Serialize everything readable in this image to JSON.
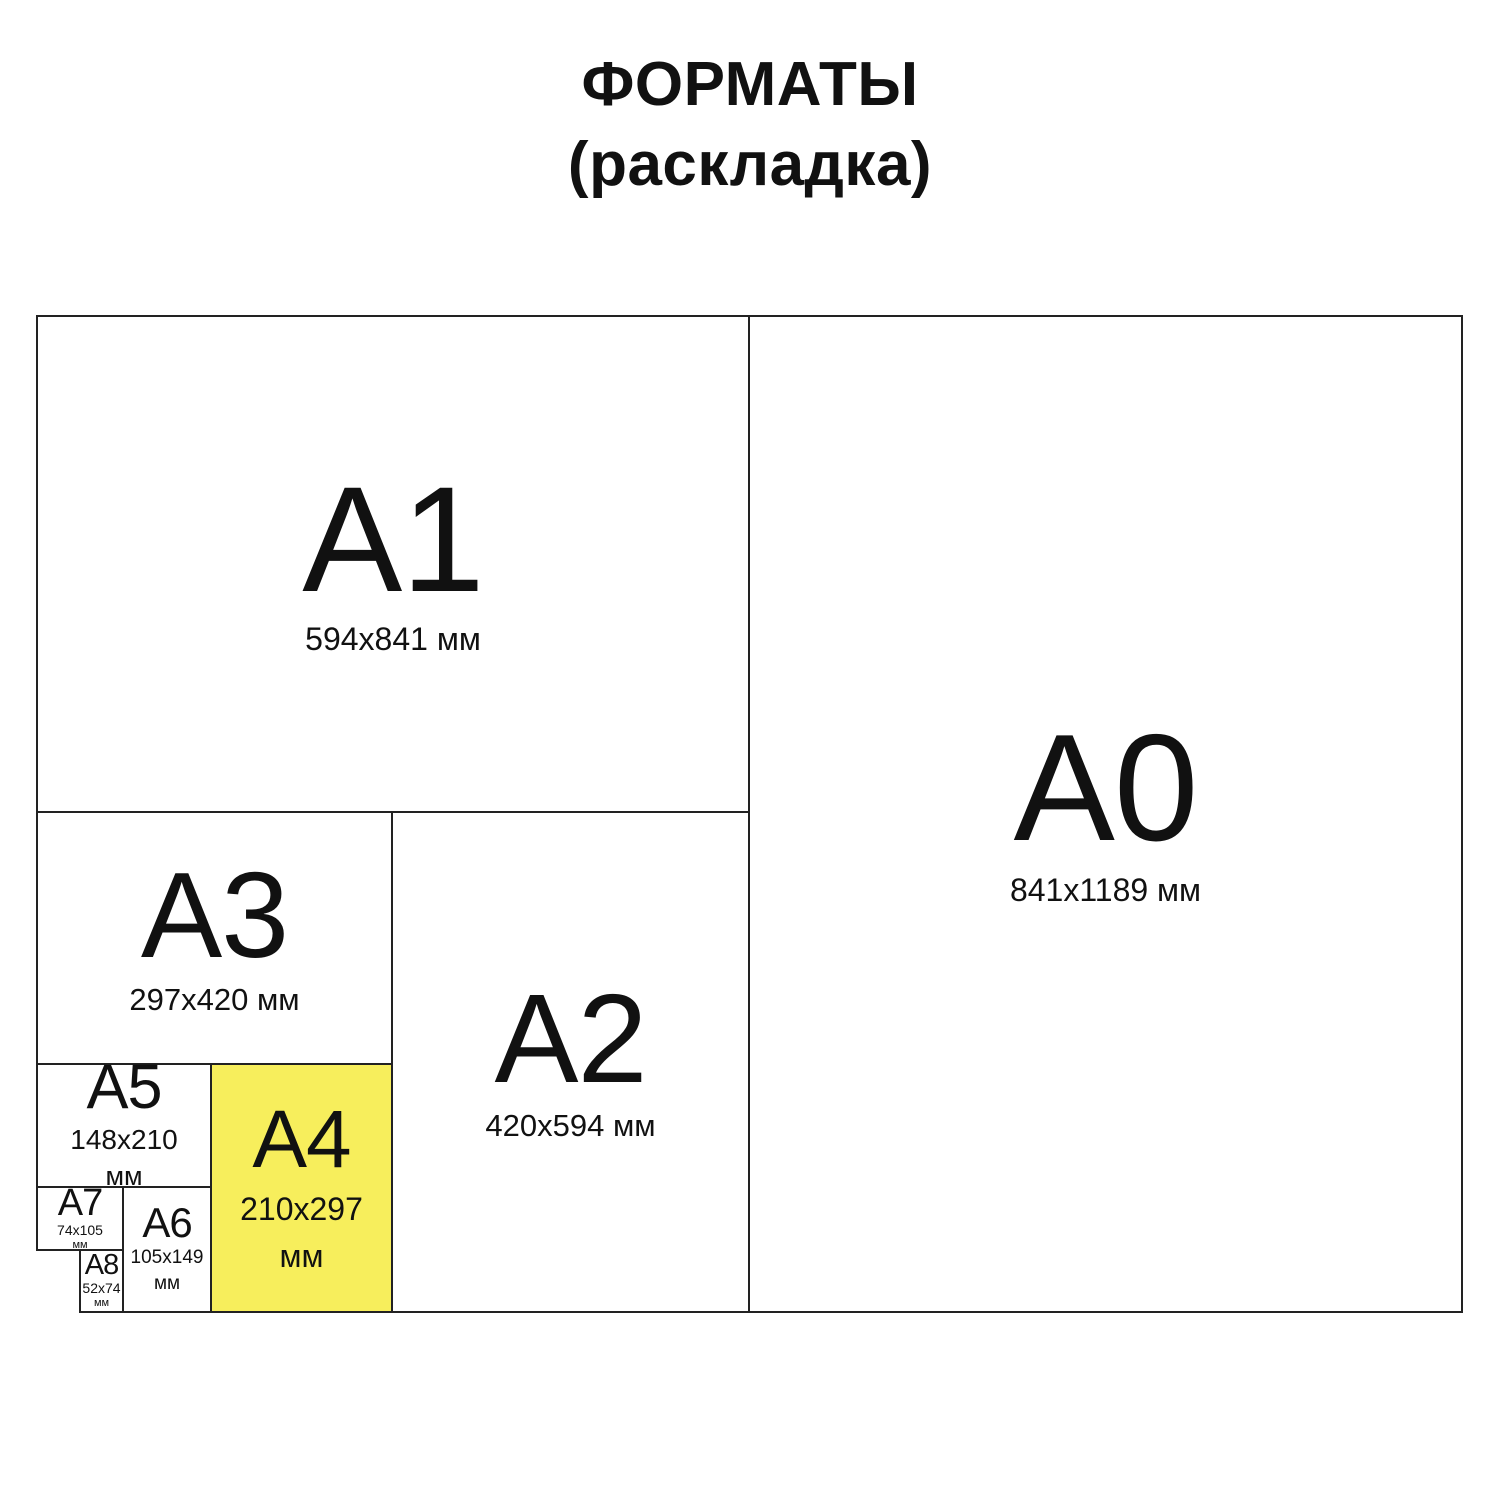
{
  "title": {
    "line1": "ФОРМАТЫ",
    "line2": "(раскладка)"
  },
  "colors": {
    "canvas": "#FFFFFF",
    "line": "#222222",
    "text": "#111111",
    "highlight": "#F7EE5C"
  },
  "formats": {
    "a0": {
      "label": "A0",
      "dimensions": "841x1189 мм",
      "highlighted": false
    },
    "a1": {
      "label": "A1",
      "dimensions": "594x841 мм",
      "highlighted": false
    },
    "a2": {
      "label": "A2",
      "dimensions": "420x594 мм",
      "highlighted": false
    },
    "a3": {
      "label": "A3",
      "dimensions": "297x420 мм",
      "highlighted": false
    },
    "a4": {
      "label": "A4",
      "dimensions": "210x297",
      "unit": "мм",
      "highlighted": true
    },
    "a5": {
      "label": "A5",
      "dimensions": "148x210",
      "unit": "мм",
      "highlighted": false
    },
    "a6": {
      "label": "A6",
      "dimensions": "105x149",
      "unit": "мм",
      "highlighted": false
    },
    "a7": {
      "label": "A7",
      "dimensions": "74x105",
      "unit": "мм",
      "highlighted": false
    },
    "a8": {
      "label": "A8",
      "dimensions": "52x74",
      "unit": "мм",
      "highlighted": false
    }
  }
}
